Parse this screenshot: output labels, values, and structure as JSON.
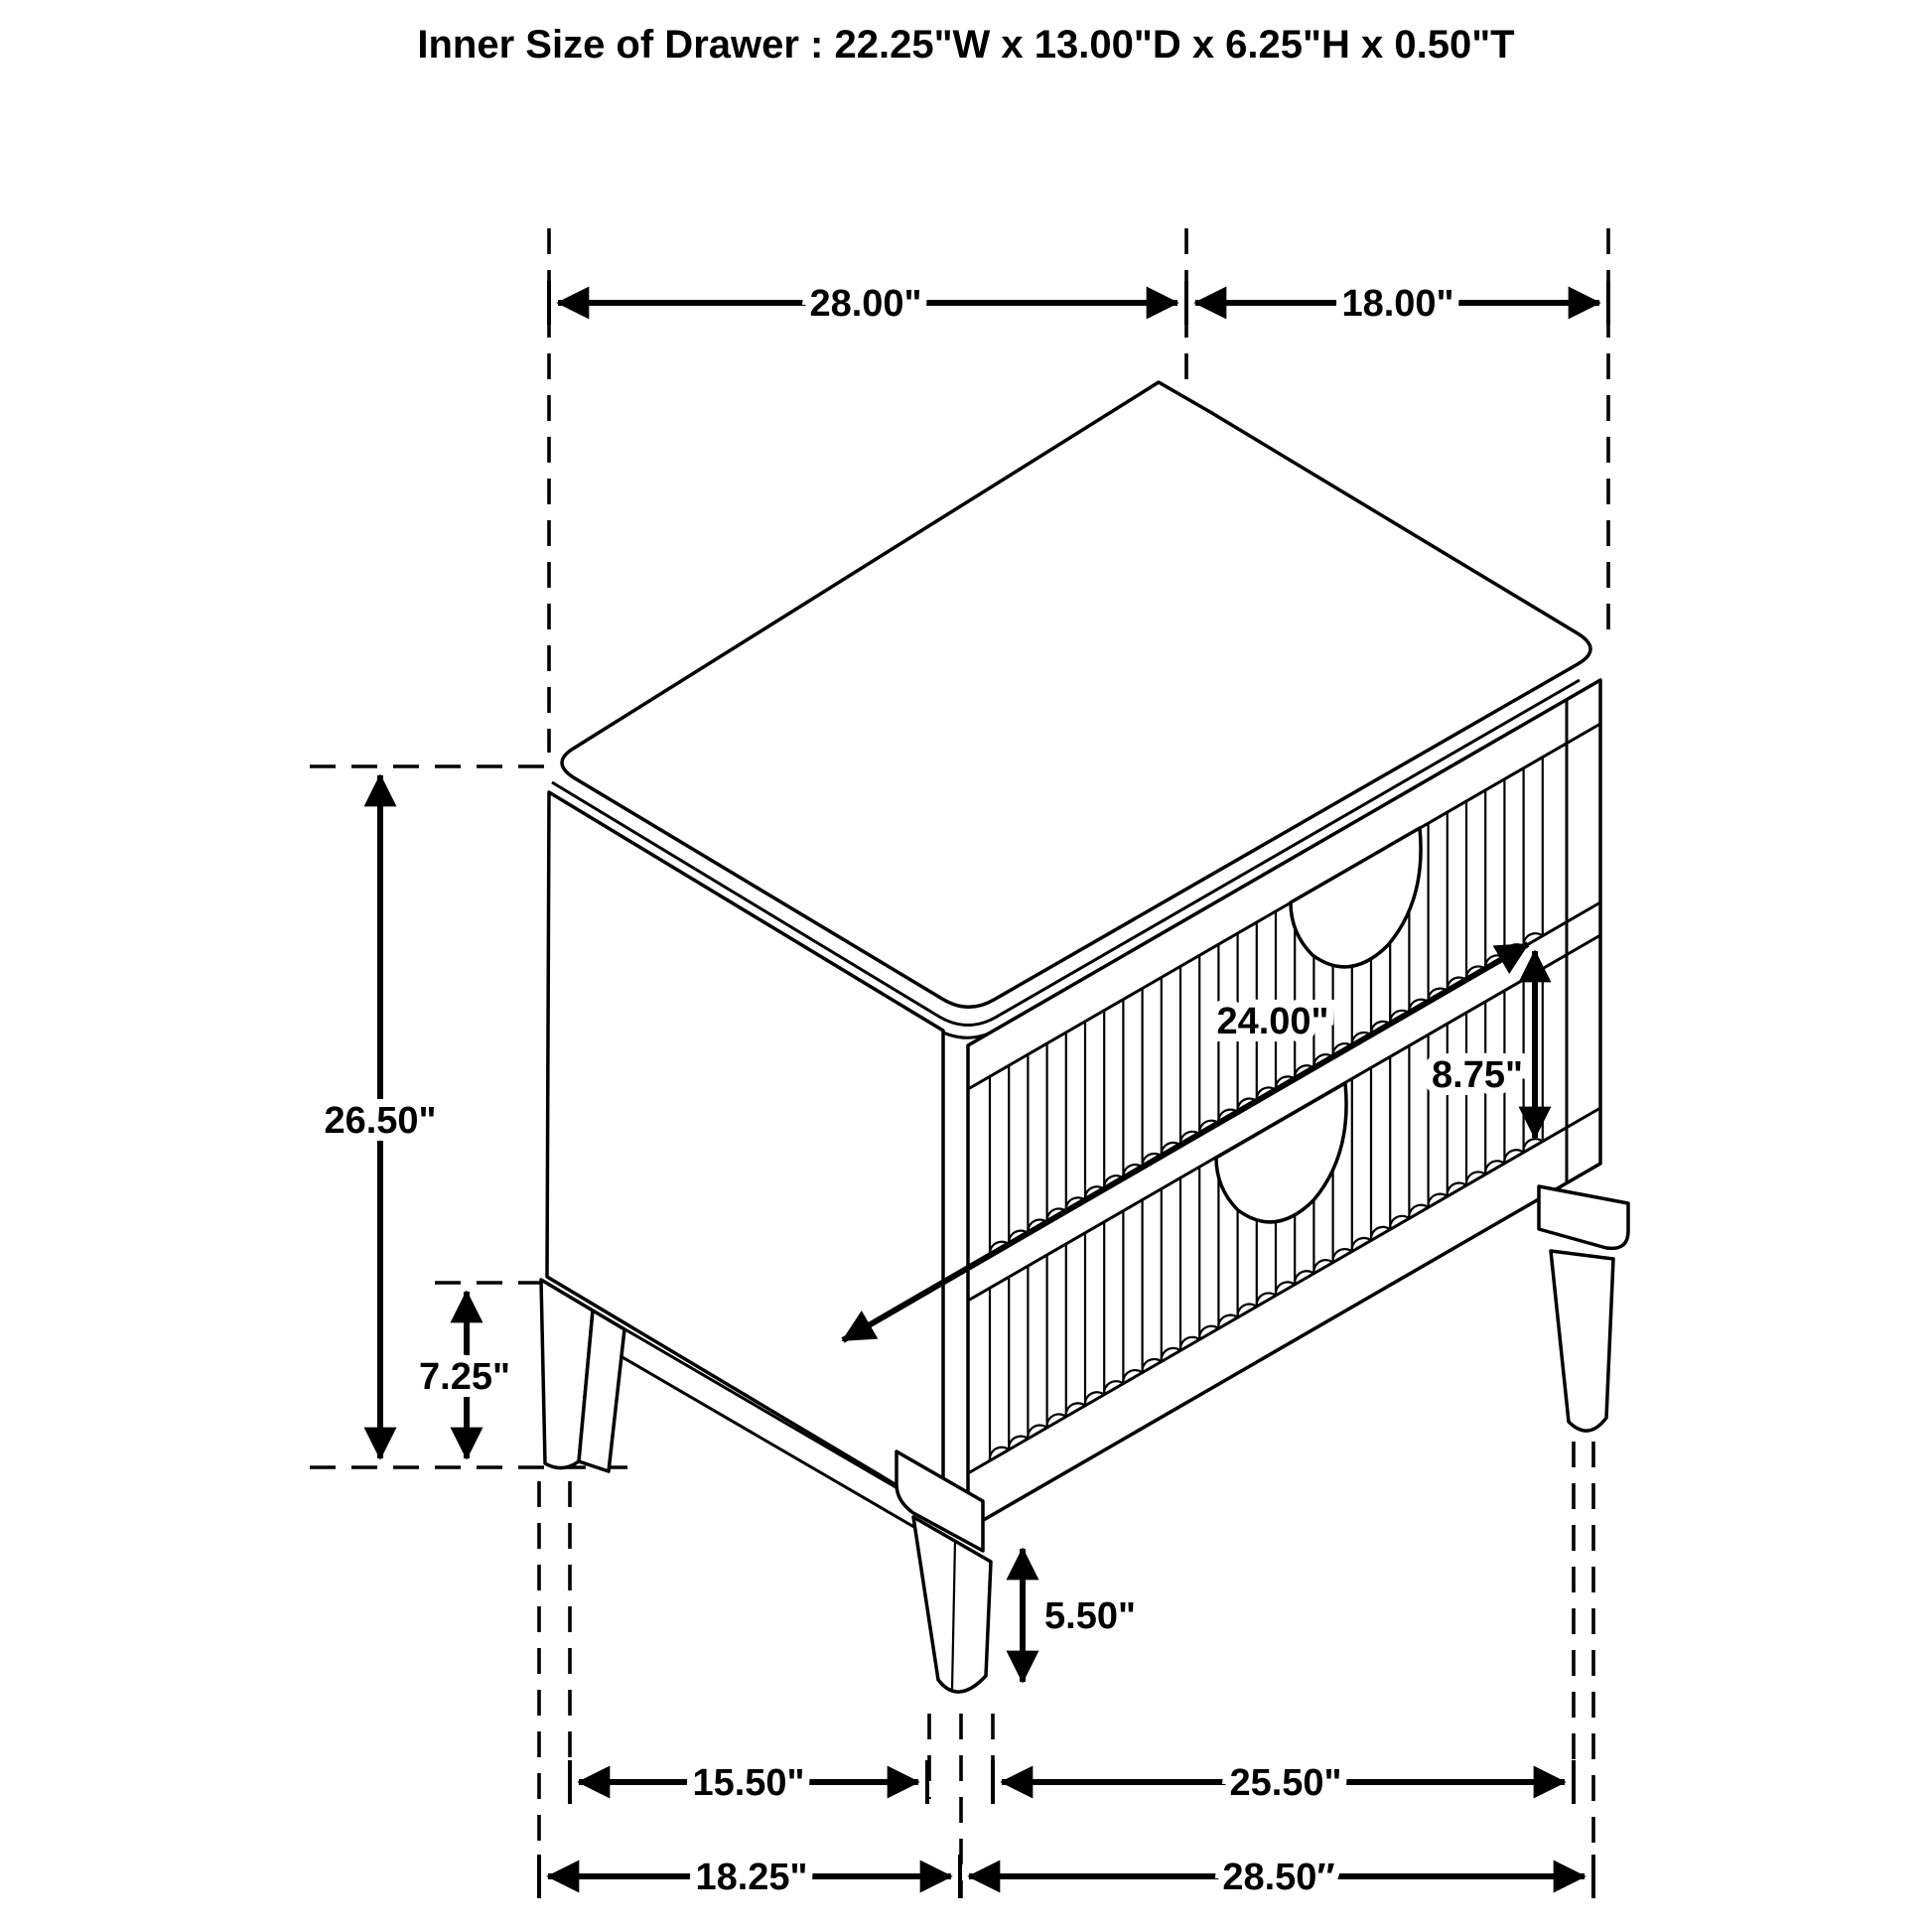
{
  "title": "Inner Size of Drawer : 22.25\"W x 13.00\"D x 6.25\"H x 0.50\"T",
  "diagram": {
    "subject": "two-drawer nightstand isometric dimension drawing",
    "line_color": "#000000",
    "background_color": "#ffffff",
    "dimensions": {
      "top_width": "28.00\"",
      "top_depth": "18.00\"",
      "overall_height": "26.50\"",
      "side_leg_height": "7.25\"",
      "drawer_front_width": "24.00\"",
      "drawer_front_height": "8.75\"",
      "front_leg_height": "5.50\"",
      "side_leg_spacing": "15.50\"",
      "front_leg_spacing": "25.50\"",
      "base_depth": "18.25\"",
      "base_width": "28.50″"
    }
  }
}
